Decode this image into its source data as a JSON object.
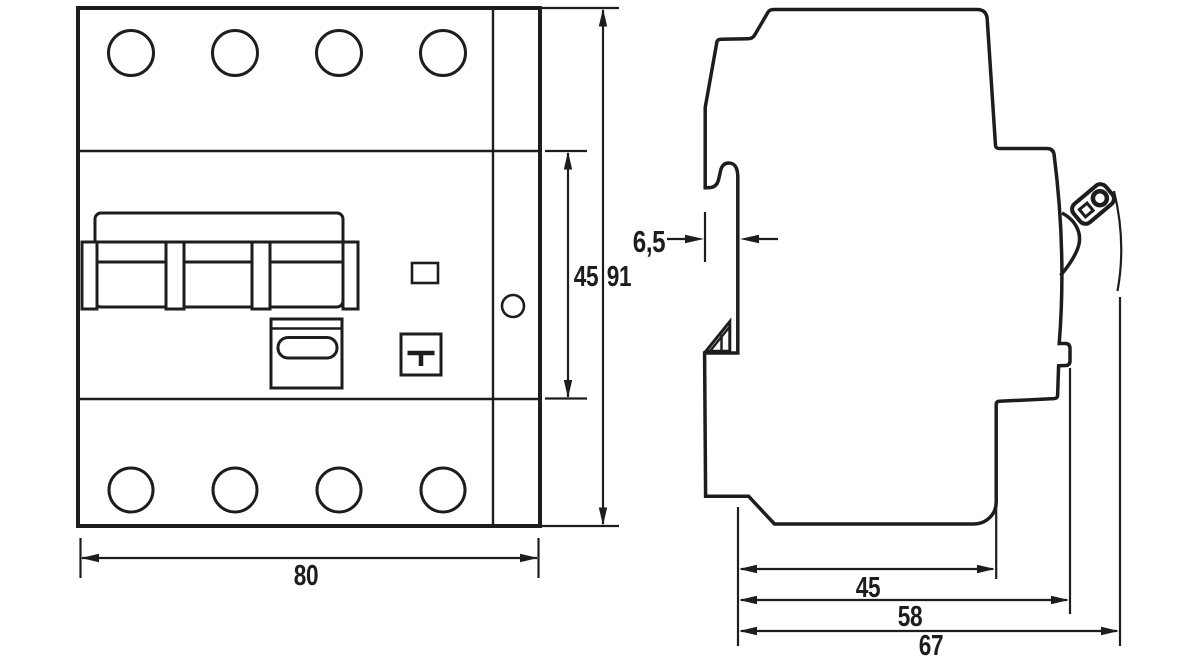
{
  "style": {
    "ink_color": "#1d1d1b",
    "background_color": "#ffffff"
  },
  "front_view": {
    "dim_module_height": "45",
    "dim_height": "91",
    "dim_width": "80"
  },
  "side_view": {
    "dim_front_offset": "6,5",
    "dim_rail_depth": "45",
    "dim_body_depth": "58",
    "dim_total_depth": "67"
  }
}
